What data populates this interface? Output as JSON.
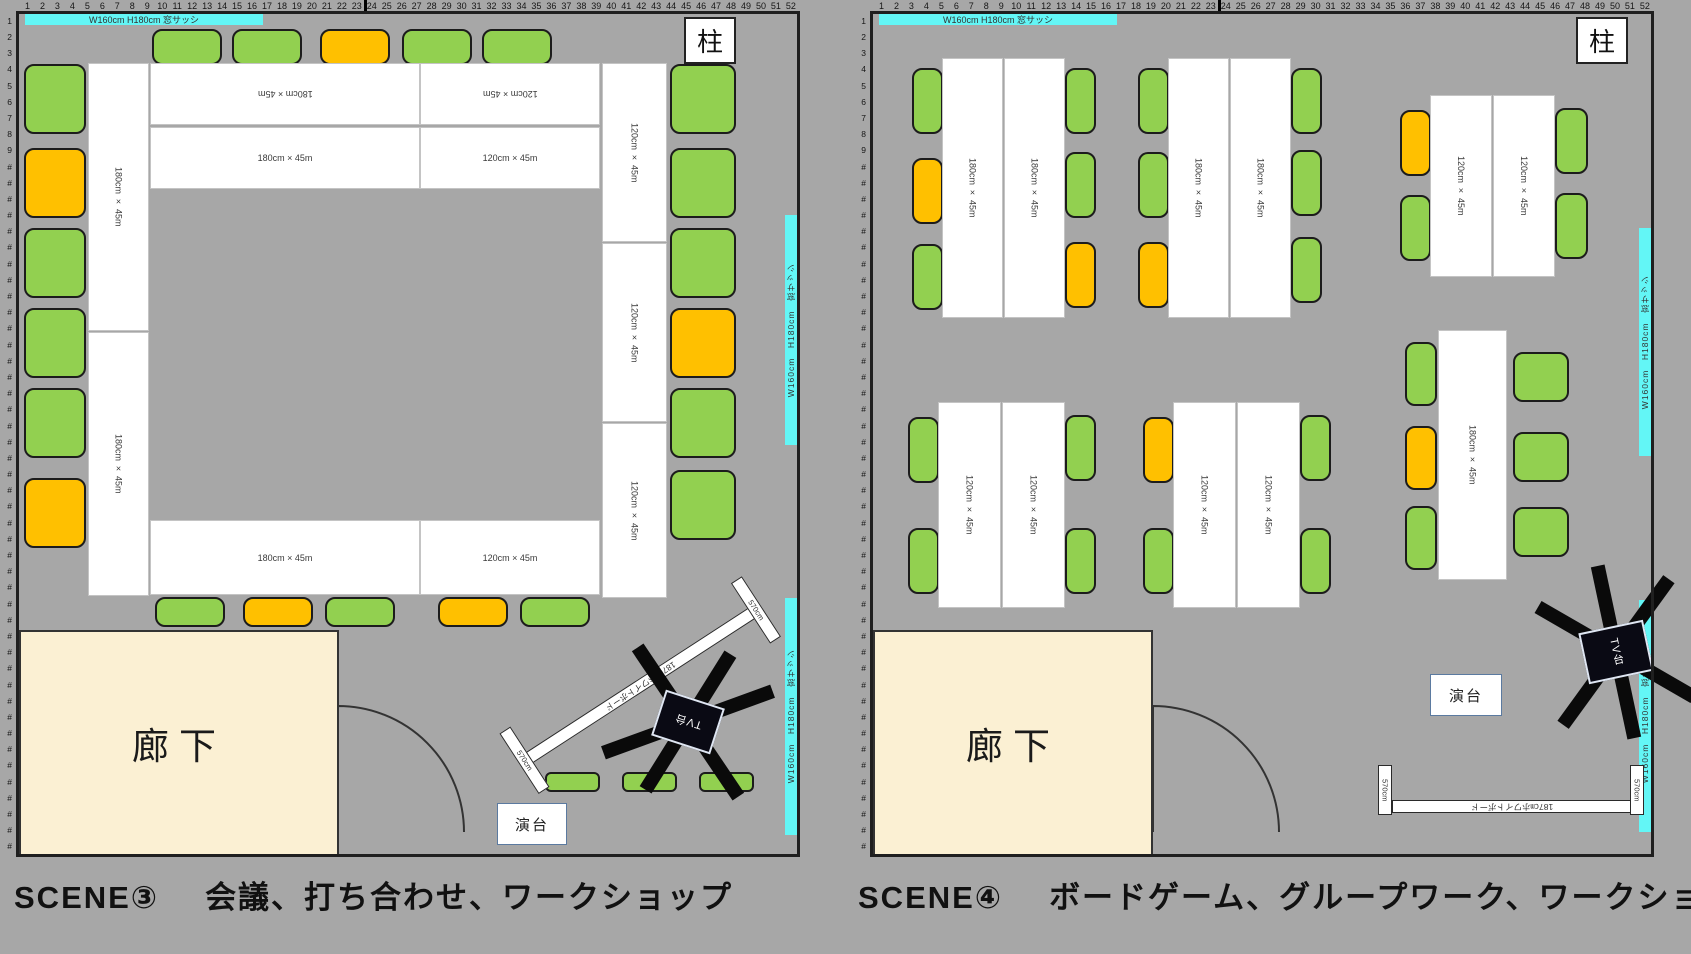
{
  "colors": {
    "background": "#a7a7a7",
    "wall": "#1f1f1f",
    "chair-green": "#92d050",
    "chair-orange": "#ffc000",
    "table-fill": "#ffffff",
    "table-border": "#c4c4c4",
    "corridor-fill": "#fbf0d3",
    "window-cyan": "#63f6f6",
    "tv-black": "#0a0a14",
    "podium-border": "#5b7aa0"
  },
  "rulers": {
    "columns": [
      "1",
      "2",
      "3",
      "4",
      "5",
      "6",
      "7",
      "8",
      "9",
      "10",
      "11",
      "12",
      "13",
      "14",
      "15",
      "16",
      "17",
      "18",
      "19",
      "20",
      "21",
      "22",
      "23",
      "24",
      "25",
      "26",
      "27",
      "28",
      "29",
      "30",
      "31",
      "32",
      "33",
      "34",
      "35",
      "36",
      "37",
      "38",
      "39",
      "40",
      "41",
      "42",
      "43",
      "44",
      "45",
      "46",
      "47",
      "48",
      "49",
      "50",
      "51",
      "52"
    ],
    "rows_numbered": [
      "1",
      "2",
      "3",
      "4",
      "5",
      "6",
      "7",
      "8",
      "9"
    ],
    "row_overflow_symbol": "#",
    "total_rows": 52
  },
  "window": {
    "top_label": "W160cm   H180cm   窓サッシ",
    "side_label": "W160cm　H180cm　窓サッシ"
  },
  "labels": {
    "pillar": "柱",
    "corridor": "廊下",
    "podium": "演台",
    "tv_stand": "TV台",
    "whiteboard": "187㎝ホワイトボード",
    "whiteboard_end": "570cm",
    "table_180": "180cm × 45m",
    "table_120": "120cm × 45m"
  },
  "captions": {
    "scene3_title": "SCENE③",
    "scene3_desc": "会議、打ち合わせ、ワークショップ",
    "scene4_title": "SCENE④",
    "scene4_desc": "ボードゲーム、グループワーク、ワークショップ"
  }
}
